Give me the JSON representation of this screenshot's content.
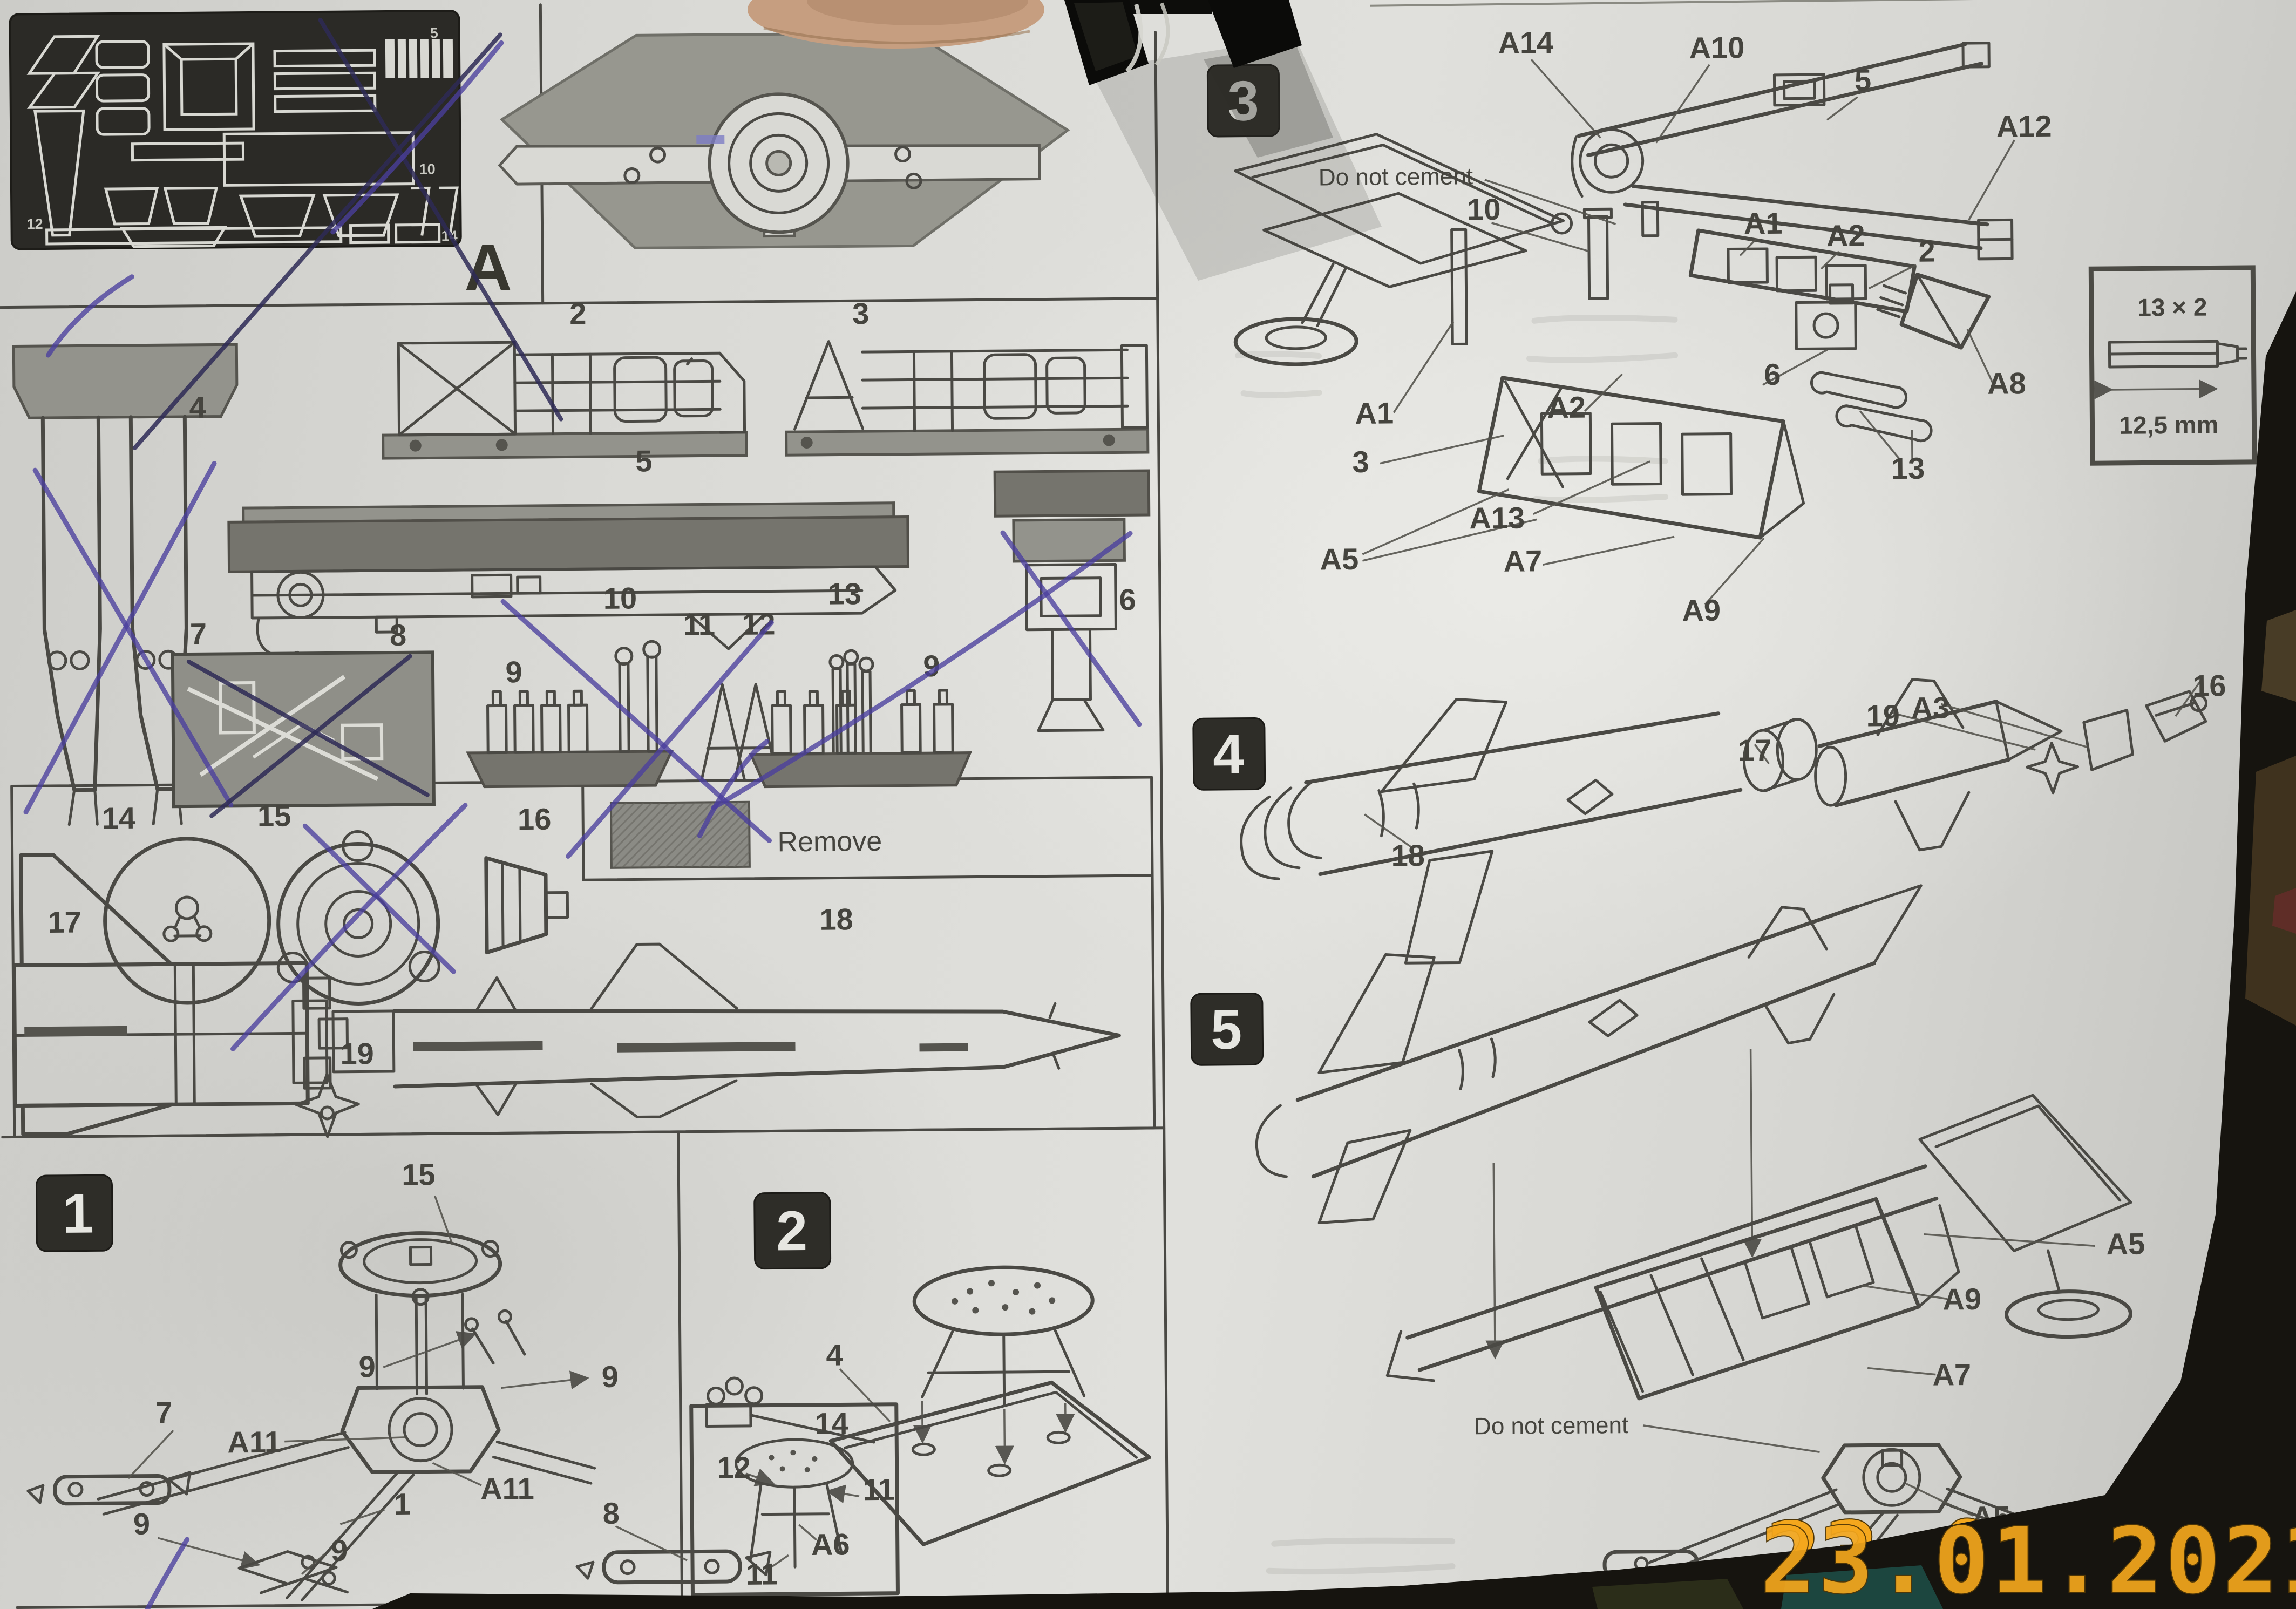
{
  "document_kind": "model kit assembly instruction sheet (photograph)",
  "fret": {
    "letter": "A",
    "numbers": [
      "5",
      "10",
      "12",
      "14"
    ]
  },
  "parts": {
    "labels": [
      "2",
      "3",
      "4",
      "5",
      "6",
      "7",
      "8",
      "9",
      "10",
      "11",
      "12",
      "13",
      "9",
      "14",
      "15",
      "16",
      "17",
      "18",
      "19"
    ]
  },
  "legend": {
    "remove": "Remove"
  },
  "steps": {
    "s1": {
      "badge": "1",
      "callouts": [
        "15",
        "7",
        "A11",
        "9",
        "9",
        "A11",
        "8",
        "1",
        "9",
        "9"
      ]
    },
    "s2": {
      "badge": "2",
      "callouts": [
        "4",
        "14",
        "12",
        "11",
        "A6",
        "11"
      ]
    },
    "s3": {
      "badge": "3",
      "note": "Do not cement",
      "callouts": [
        "A14",
        "A10",
        "5",
        "A12",
        "2",
        "10",
        "A1",
        "A2",
        "A1",
        "A2",
        "6",
        "A8",
        "3",
        "13",
        "A13",
        "A5",
        "A7",
        "A9"
      ]
    },
    "s4": {
      "badge": "4",
      "callouts": [
        "18",
        "17",
        "19",
        "A3",
        "16"
      ]
    },
    "s5": {
      "badge": "5",
      "note": "Do not cement",
      "callouts": [
        "A5",
        "A9",
        "A7",
        "A5"
      ]
    }
  },
  "measure_box": {
    "count": "13 × 2",
    "length": "12,5 mm"
  },
  "date_stamp": "23.01.2021",
  "colors": {
    "pen": "#4a3f9e",
    "date_stamp": "#f4a71d",
    "paper": "#dadad6",
    "ink": "#4a4944"
  }
}
